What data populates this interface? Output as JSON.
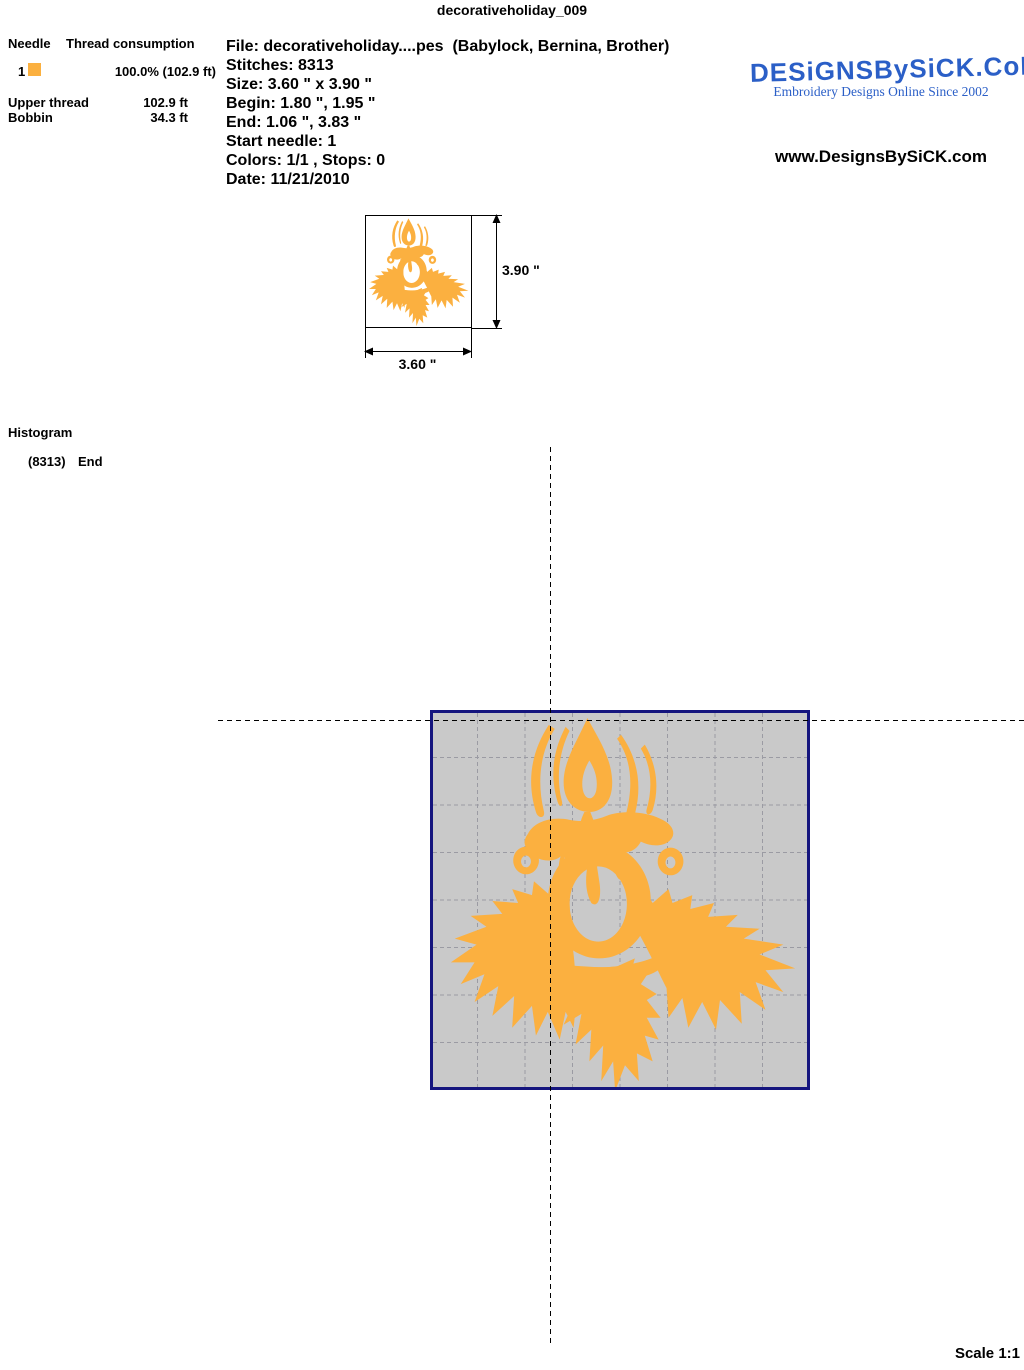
{
  "title": "decorativeholiday_009",
  "thread_table": {
    "header_needle": "Needle",
    "header_consumption": "Thread consumption",
    "rows": [
      {
        "needle": "1",
        "swatch_color": "#FBB03F",
        "consumption": "100.0% (102.9 ft)"
      }
    ],
    "upper_thread_label": "Upper thread",
    "upper_thread_value": "102.9 ft",
    "bobbin_label": "Bobbin",
    "bobbin_value": "34.3 ft"
  },
  "file_info": {
    "file": "File: decorativeholiday....pes  (Babylock, Bernina, Brother)",
    "stitches": "Stitches: 8313",
    "size": "Size: 3.60 \" x 3.90 \"",
    "begin": "Begin: 1.80 \", 1.95 \"",
    "end": "End: 1.06 \", 3.83 \"",
    "start_needle": "Start needle: 1",
    "colors": "Colors: 1/1 , Stops: 0",
    "date": "Date: 11/21/2010"
  },
  "brand": {
    "logo_text": "DESiGNSBySiCK.CoM",
    "tagline": "Embroidery Designs Online Since 2002",
    "website": "www.DesignsBySiCK.com",
    "logo_color": "#2B5FC7"
  },
  "dimensions": {
    "height_label": "3.90 \"",
    "width_label": "3.60 \""
  },
  "histogram": {
    "title": "Histogram",
    "entry_count": "(8313)",
    "entry_label": "End"
  },
  "preview": {
    "background": "#C9C9C9",
    "border_color": "#15157E",
    "grid_color": "#9B9BA3",
    "design_color": "#FBB040",
    "design_name": "candle-with-holly-leaves"
  },
  "scale_label": "Scale 1:1"
}
